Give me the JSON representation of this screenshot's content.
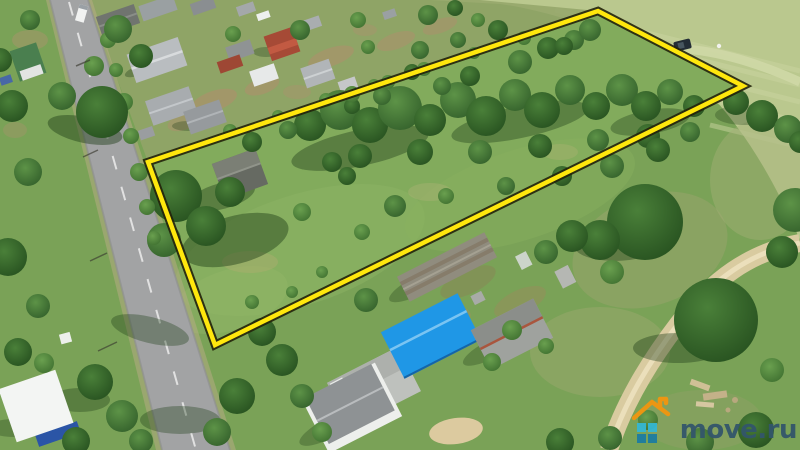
{
  "image": {
    "kind": "aerial-drone-photo",
    "subject": "rural village land plot outlined in yellow for a real-estate listing",
    "width_px": 800,
    "height_px": 450
  },
  "overlay": {
    "boundary": {
      "points": "148,162 598,11 743,86 215,345",
      "shape": "quadrilateral",
      "stroke_color": "#ffe70d",
      "outline_color": "#22220a",
      "stroke_width": 4.5,
      "outline_width": 8.5
    }
  },
  "watermark": {
    "text": "move.ru",
    "text_color": "#33566b",
    "logo": {
      "house_outline_color": "#f2960f",
      "pixel_light_color": "#35b7d2",
      "pixel_dark_color": "#1d7da1"
    }
  },
  "scene": {
    "ground_color": "#7aa257",
    "field_color": "#bac88e",
    "asphalt_color": "#a2a3a4",
    "dirt_road_color": "#d9cba0",
    "plot_grass_color": "#82ab5c",
    "blue_roof_color": "#1f97e6",
    "features": [
      "asphalt road with dashed centerline along the left side",
      "village houses with gray roofs along the street",
      "red-roofed barn house in the village row",
      "large grassy plot with tree clusters outlined in yellow",
      "old gray-roofed house inside the outlined plot",
      "pale mowed field in the upper right with a car on a track",
      "farmstead with bright blue metal roof house at bottom center",
      "white house with hipped gray roof at bottom",
      "white building with blue wall at bottom left",
      "sandy dirt road curving through the lower right",
      "move.ru watermark in the bottom right corner"
    ]
  }
}
